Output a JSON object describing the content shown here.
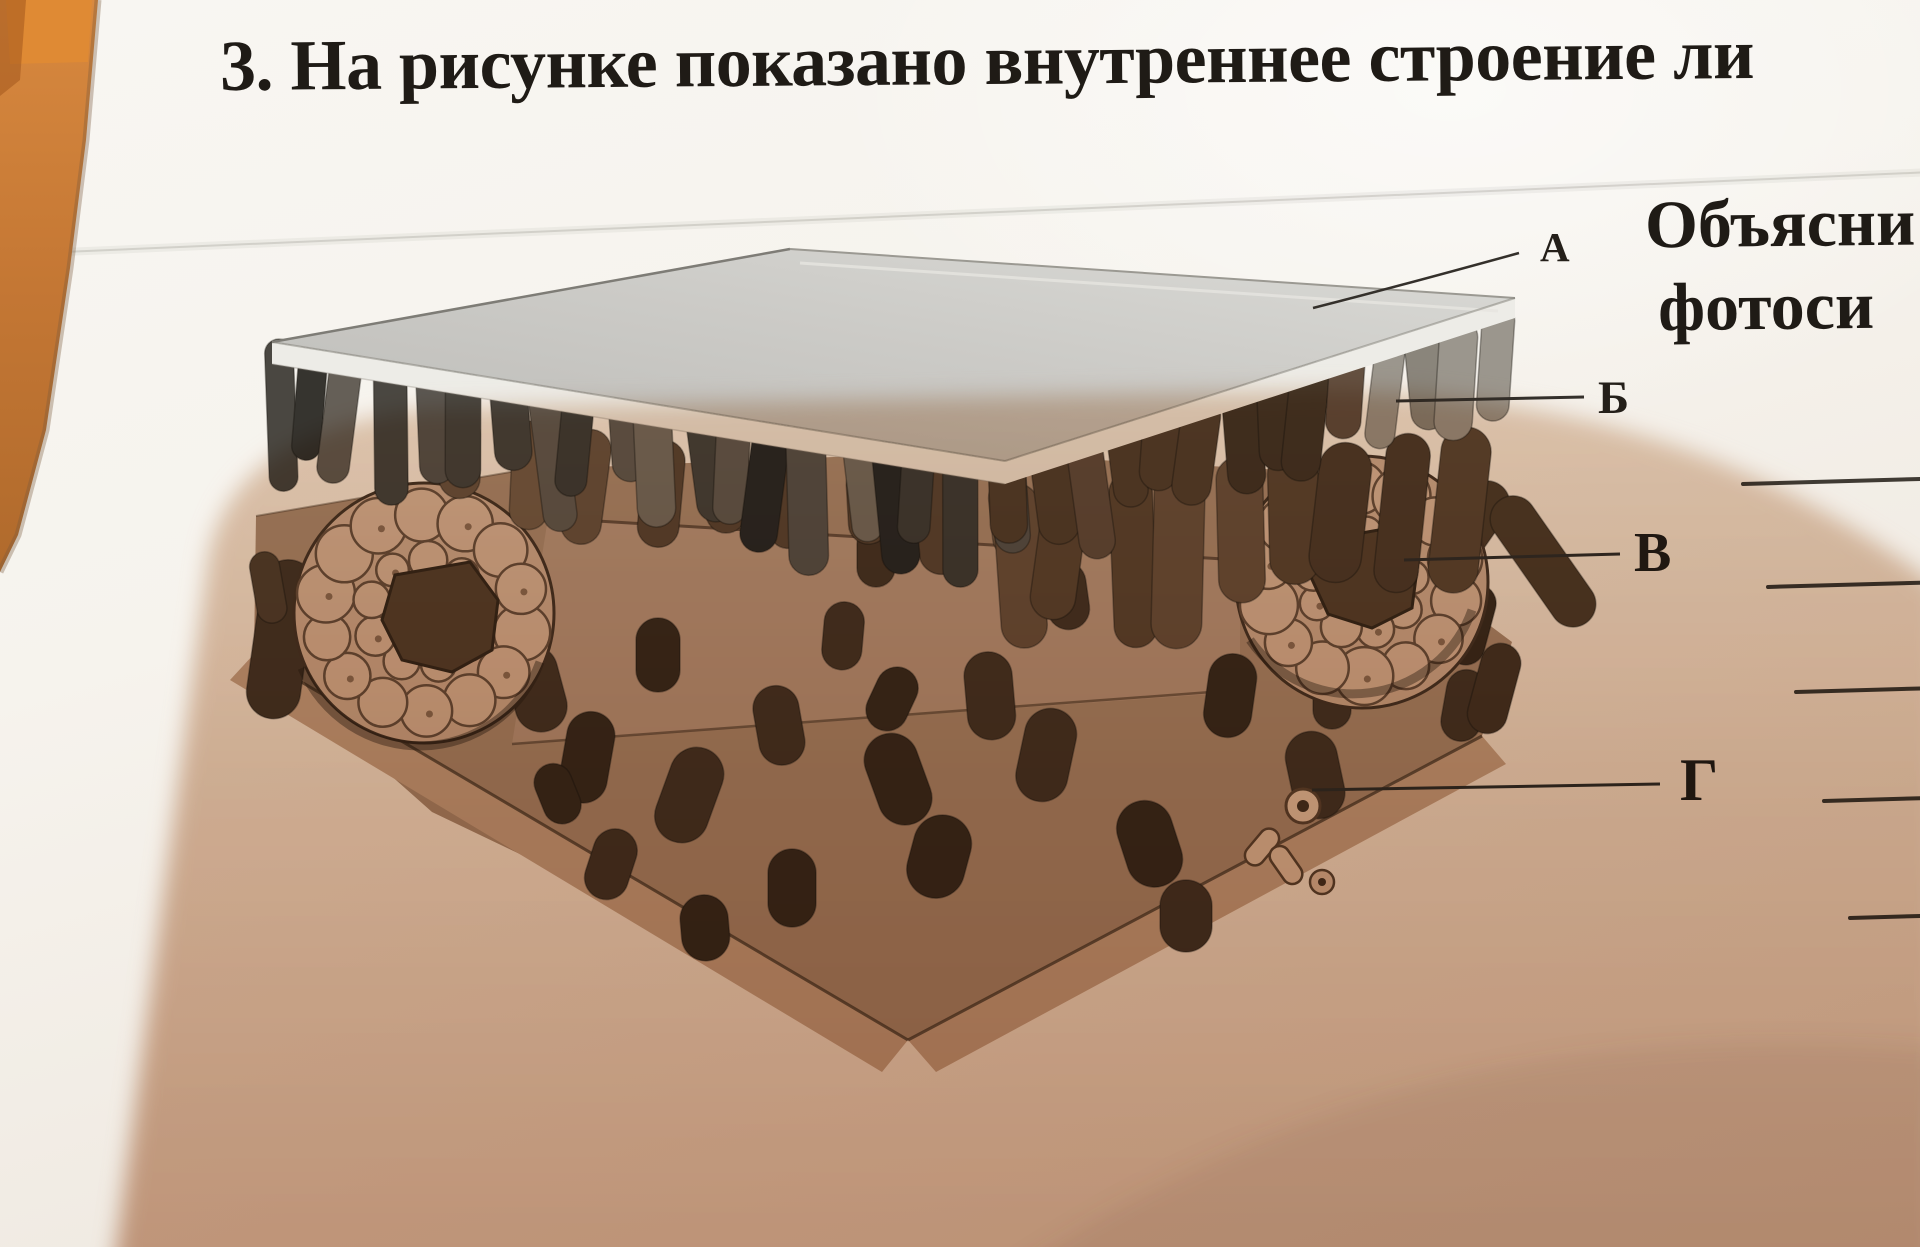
{
  "page": {
    "title": "3. На рисунке показано внутреннее строение ли",
    "side_text": [
      "Объясни",
      "фотоси"
    ]
  },
  "figure": {
    "description_visible": "leaf internal structure 3D cross-section drawing",
    "labels": [
      {
        "letter": "А"
      },
      {
        "letter": "Б"
      },
      {
        "letter": "В"
      },
      {
        "letter": "Г"
      }
    ]
  },
  "answer_lines": {
    "count": 5
  },
  "colors": {
    "paper": "#f6f3ee",
    "photo_shadow": "#cfa98f",
    "wood_table": "#c97b35",
    "ink": "#1f1b16",
    "epidermis_gray": "#cbcac6",
    "tissue_tan": "#cdb29c",
    "tissue_dark": "#4a3929"
  }
}
